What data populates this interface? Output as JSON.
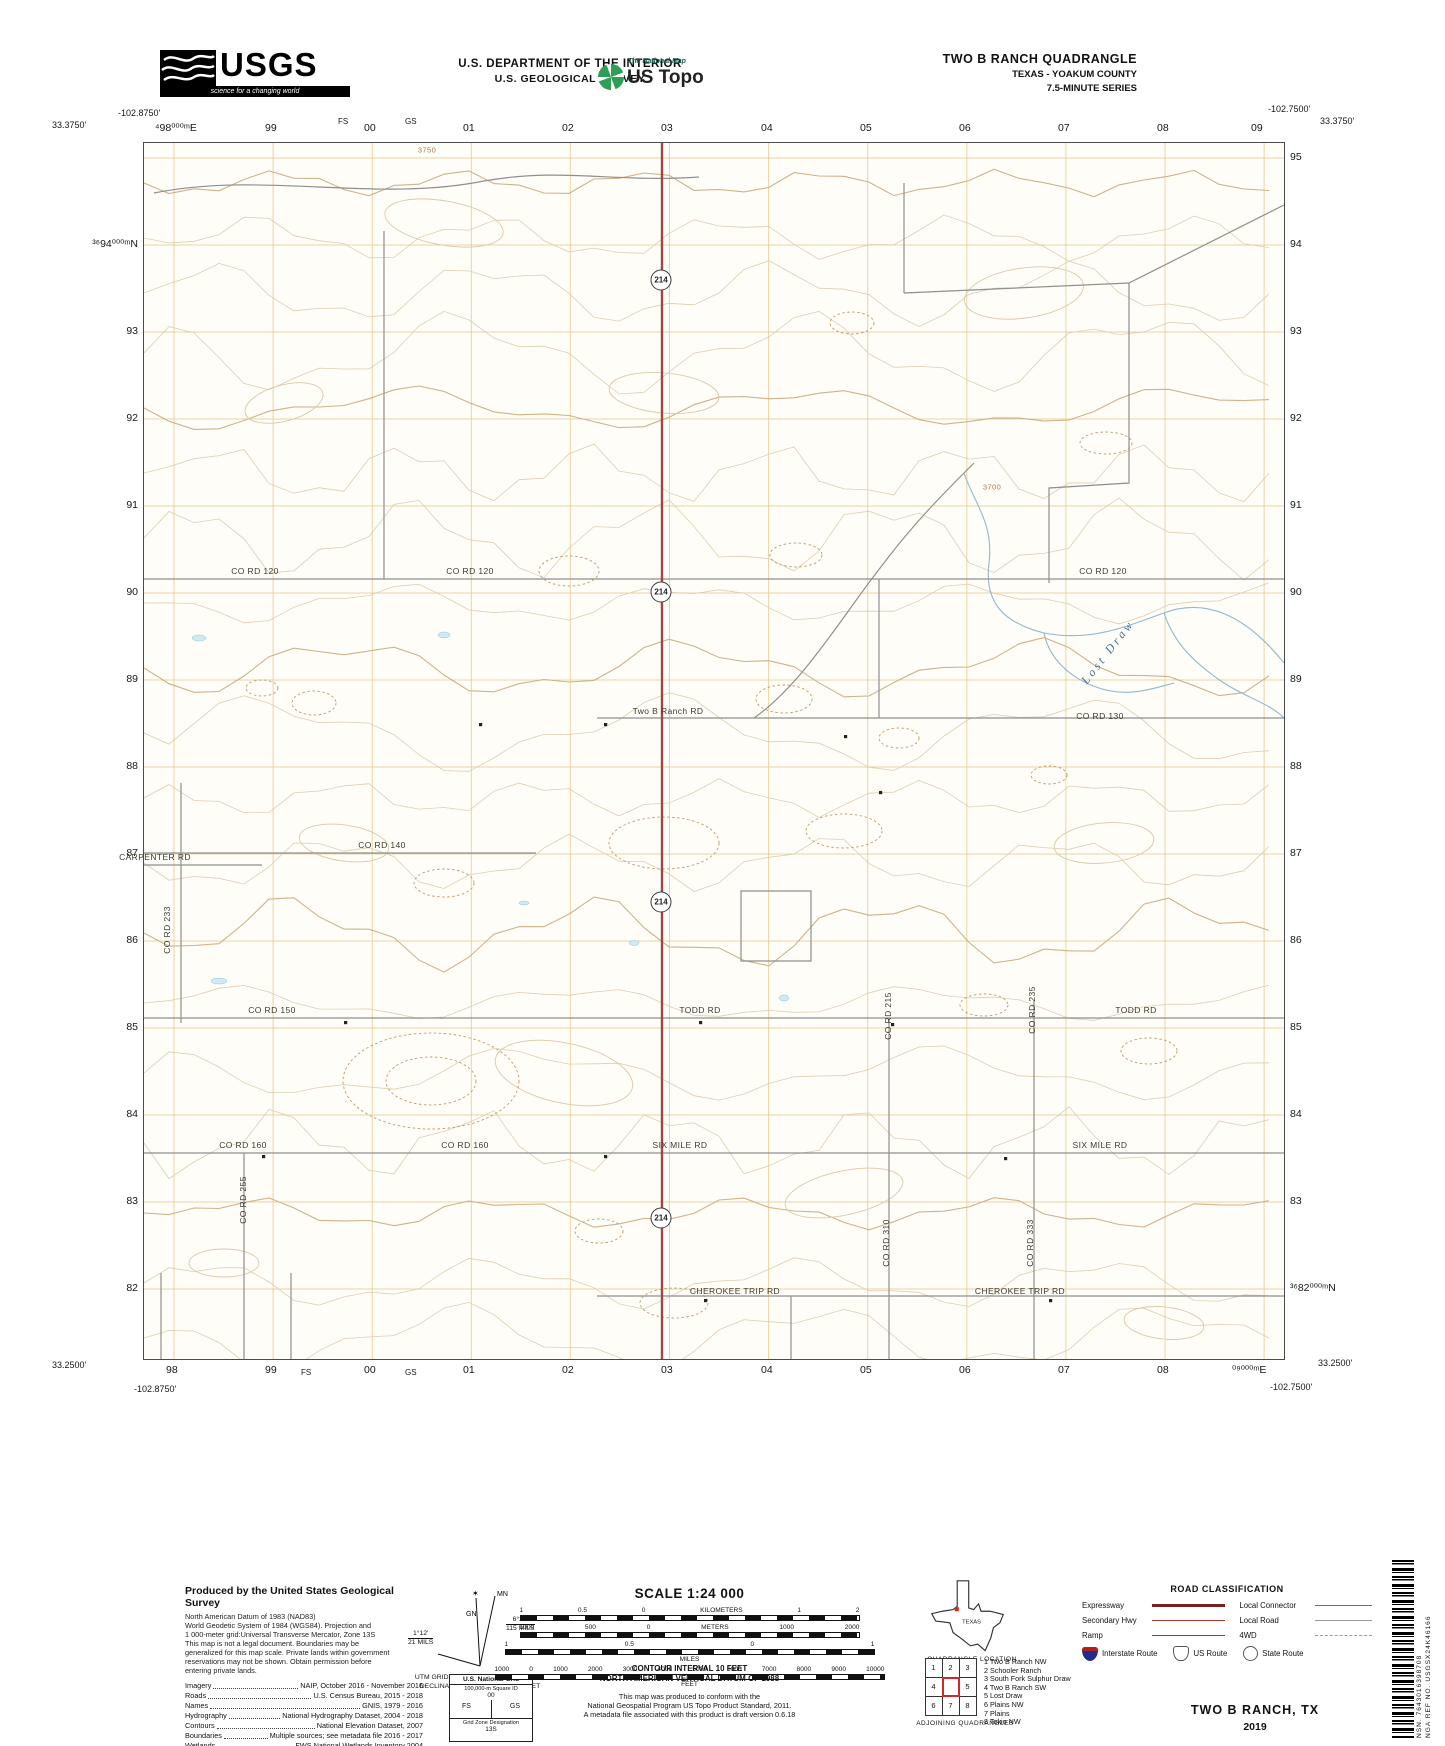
{
  "colors": {
    "accent_red": "#a04545",
    "grid_orange": "#e3c887",
    "contour_tan": "#dcc9a8",
    "index_contour": "#c9ab7e",
    "road_gray": "#8f8f8f",
    "stream_blue": "#90b8cc",
    "topo_green": "#2f9e57",
    "legend_dark_red": "#7a1d1d",
    "legend_red": "#a33a30"
  },
  "header": {
    "usgs": {
      "word": "USGS",
      "tagline": "science for a changing world"
    },
    "dept_line1": "U.S. DEPARTMENT OF THE INTERIOR",
    "dept_line2": "U.S. GEOLOGICAL SURVEY",
    "ustopo": {
      "small": "The National Map",
      "big": "US Topo"
    },
    "quad": {
      "line1": "TWO B RANCH QUADRANGLE",
      "line2": "TEXAS - YOAKUM COUNTY",
      "line3": "7.5-MINUTE SERIES"
    }
  },
  "corners": {
    "tl_lon": "-102.8750'",
    "tl_lat": "33.3750'",
    "tr_lon": "-102.7500'",
    "tr_lat": "33.3750'",
    "bl_lat": "33.2500'",
    "bl_lon": "-102.8750'",
    "br_lon": "-102.7500'",
    "br_lat": "33.2500'"
  },
  "grid": {
    "top": [
      {
        "x": 173,
        "label": "⁴98⁰⁰⁰ᵐE"
      },
      {
        "x": 272,
        "label": "99"
      },
      {
        "x": 345,
        "label": "FS",
        "small": true
      },
      {
        "x": 371,
        "label": "00"
      },
      {
        "x": 412,
        "label": "GS",
        "small": true
      },
      {
        "x": 470,
        "label": "01"
      },
      {
        "x": 569,
        "label": "02"
      },
      {
        "x": 668,
        "label": "03"
      },
      {
        "x": 768,
        "label": "04"
      },
      {
        "x": 867,
        "label": "05"
      },
      {
        "x": 966,
        "label": "06"
      },
      {
        "x": 1065,
        "label": "07"
      },
      {
        "x": 1164,
        "label": "08"
      },
      {
        "x": 1258,
        "label": "09"
      }
    ],
    "bottom": [
      {
        "x": 173,
        "label": "98"
      },
      {
        "x": 272,
        "label": "99"
      },
      {
        "x": 308,
        "label": "FS",
        "small": true
      },
      {
        "x": 371,
        "label": "00"
      },
      {
        "x": 412,
        "label": "GS",
        "small": true
      },
      {
        "x": 470,
        "label": "01"
      },
      {
        "x": 569,
        "label": "02"
      },
      {
        "x": 668,
        "label": "03"
      },
      {
        "x": 768,
        "label": "04"
      },
      {
        "x": 867,
        "label": "05"
      },
      {
        "x": 966,
        "label": "06"
      },
      {
        "x": 1065,
        "label": "07"
      },
      {
        "x": 1164,
        "label": "08"
      },
      {
        "x": 1250,
        "label": "⁰⁹⁰⁰⁰ᵐE"
      }
    ],
    "left": [
      {
        "y": 244,
        "label": "³⁶94⁰⁰⁰ᵐN"
      },
      {
        "y": 331,
        "label": "93"
      },
      {
        "y": 418,
        "label": "92"
      },
      {
        "y": 505,
        "label": "91"
      },
      {
        "y": 592,
        "label": "90"
      },
      {
        "y": 679,
        "label": "89"
      },
      {
        "y": 766,
        "label": "88"
      },
      {
        "y": 853,
        "label": "87"
      },
      {
        "y": 940,
        "label": "86"
      },
      {
        "y": 1027,
        "label": "85"
      },
      {
        "y": 1114,
        "label": "84"
      },
      {
        "y": 1201,
        "label": "83"
      },
      {
        "y": 1288,
        "label": "82"
      }
    ],
    "right": [
      {
        "y": 157,
        "label": "95"
      },
      {
        "y": 244,
        "label": "94"
      },
      {
        "y": 331,
        "label": "93"
      },
      {
        "y": 418,
        "label": "92"
      },
      {
        "y": 505,
        "label": "91"
      },
      {
        "y": 592,
        "label": "90"
      },
      {
        "y": 679,
        "label": "89"
      },
      {
        "y": 766,
        "label": "88"
      },
      {
        "y": 853,
        "label": "87"
      },
      {
        "y": 940,
        "label": "86"
      },
      {
        "y": 1027,
        "label": "85"
      },
      {
        "y": 1114,
        "label": "84"
      },
      {
        "y": 1201,
        "label": "83"
      },
      {
        "y": 1288,
        "label": "³⁶82⁰⁰⁰ᵐN"
      }
    ]
  },
  "map": {
    "shield_route": "214",
    "shields": [
      {
        "x": 661,
        "y": 280
      },
      {
        "x": 661,
        "y": 592
      },
      {
        "x": 661,
        "y": 902
      },
      {
        "x": 661,
        "y": 1218
      }
    ],
    "labels": [
      {
        "t": "CO RD 120",
        "x": 255,
        "y": 571
      },
      {
        "t": "CO RD 120",
        "x": 470,
        "y": 571
      },
      {
        "t": "CO RD 120",
        "x": 1103,
        "y": 571
      },
      {
        "t": "Two B Ranch  RD",
        "x": 668,
        "y": 711
      },
      {
        "t": "CO RD 130",
        "x": 1100,
        "y": 716
      },
      {
        "t": "CO RD 140",
        "x": 382,
        "y": 845
      },
      {
        "t": "CARPENTER RD",
        "x": 155,
        "y": 857
      },
      {
        "t": "CO RD 233",
        "x": 167,
        "y": 930,
        "rot": -90
      },
      {
        "t": "CO RD 150",
        "x": 272,
        "y": 1010
      },
      {
        "t": "TODD RD",
        "x": 700,
        "y": 1010
      },
      {
        "t": "TODD RD",
        "x": 1136,
        "y": 1010
      },
      {
        "t": "CO RD 215",
        "x": 888,
        "y": 1016,
        "rot": -90
      },
      {
        "t": "CO RD 235",
        "x": 1032,
        "y": 1010,
        "rot": -90
      },
      {
        "t": "CO RD 160",
        "x": 243,
        "y": 1145
      },
      {
        "t": "CO RD 160",
        "x": 465,
        "y": 1145
      },
      {
        "t": "SIX MILE RD",
        "x": 680,
        "y": 1145
      },
      {
        "t": "SIX MILE RD",
        "x": 1100,
        "y": 1145
      },
      {
        "t": "CO RD 255",
        "x": 243,
        "y": 1200,
        "rot": -90
      },
      {
        "t": "CO RD 310",
        "x": 886,
        "y": 1243,
        "rot": -90
      },
      {
        "t": "CO RD 333",
        "x": 1030,
        "y": 1243,
        "rot": -90
      },
      {
        "t": "CHEROKEE TRIP RD",
        "x": 735,
        "y": 1291
      },
      {
        "t": "CHEROKEE TRIP RD",
        "x": 1020,
        "y": 1291
      },
      {
        "t": "Lost Draw",
        "x": 1108,
        "y": 652,
        "rot": -52,
        "cls": "stream"
      },
      {
        "t": "3750",
        "x": 427,
        "y": 150,
        "cls": "contour"
      },
      {
        "t": "3700",
        "x": 992,
        "y": 487,
        "cls": "contour"
      }
    ]
  },
  "credits": {
    "title": "Produced by the United States Geological Survey",
    "lines": [
      "North American Datum of 1983 (NAD83)",
      "World Geodetic System of 1984 (WGS84).  Projection and",
      "1 000-meter grid:Universal Transverse Mercator, Zone 13S",
      "This map is not a legal document. Boundaries may be",
      "generalized for this map scale. Private lands within government",
      "reservations may not be shown. Obtain permission before",
      "entering private lands."
    ],
    "sources": [
      {
        "k": "Imagery",
        "v": "NAIP, October 2016 - November 2016"
      },
      {
        "k": "Roads",
        "v": "U.S. Census Bureau, 2015 - 2018"
      },
      {
        "k": "Names",
        "v": "GNIS, 1979 - 2016"
      },
      {
        "k": "Hydrography",
        "v": "National Hydrography Dataset, 2004 - 2018"
      },
      {
        "k": "Contours",
        "v": "National Elevation Dataset, 2007"
      },
      {
        "k": "Boundaries",
        "v": "Multiple sources; see metadata file 2016 - 2017"
      },
      {
        "k": "Wetlands",
        "v": "FWS National Wetlands Inventory 2004"
      }
    ]
  },
  "declination": {
    "mn_label": "MN",
    "gn_label": "GN",
    "star": "✶",
    "gn_deg": "1°12'",
    "gn_mils": "21 MILS",
    "mn_deg": "6°28'",
    "mn_mils": "115 MILS",
    "caption1": "UTM GRID AND 2019 MAGNETIC NORTH",
    "caption2": "DECLINATION AT CENTER OF SHEET"
  },
  "scale": {
    "title": "SCALE 1:24 000",
    "scalebars": [
      {
        "labels": [
          "1",
          "0.5",
          "0",
          "KILOMETERS",
          "1",
          "2"
        ],
        "unit": null
      },
      {
        "labels": [
          "1000",
          "500",
          "0",
          "METERS",
          "1000",
          "2000"
        ],
        "unit": null
      },
      {
        "labels": [
          "1",
          "0.5",
          "0",
          "1"
        ],
        "unit": "MILES"
      },
      {
        "labels": [
          "1000",
          "0",
          "1000",
          "2000",
          "3000",
          "4000",
          "5000",
          "6000",
          "7000",
          "8000",
          "9000",
          "10000"
        ],
        "unit": "FEET"
      }
    ],
    "contour_note": [
      "CONTOUR INTERVAL 10 FEET",
      "NORTH AMERICAN VERTICAL DATUM OF 1988"
    ],
    "standard_note": [
      "This map was produced to conform with the",
      "National Geospatial Program US Topo Product Standard, 2011.",
      "A metadata file associated with this product is draft version 0.6.18"
    ]
  },
  "usng": {
    "title": "U.S. National Grid",
    "sub": "100,000-m Square ID",
    "center": "00",
    "left": "FS",
    "right": "GS",
    "zone_label": "Grid Zone Designation",
    "zone": "13S"
  },
  "location": {
    "state": "TEXAS",
    "caption": "QUADRANGLE LOCATION"
  },
  "adjoining": {
    "caption": "ADJOINING QUADRANGLES",
    "cells": [
      "1",
      "2",
      "3",
      "4",
      "",
      "5",
      "6",
      "7",
      "8"
    ],
    "list": [
      "1 Two B Ranch NW",
      "2 Schooler Ranch",
      "3 South Fork Sulphur Draw",
      "4 Two B Ranch SW",
      "5 Lost Draw",
      "6 Plains NW",
      "7 Plains",
      "8 Tokio NW"
    ]
  },
  "road_class": {
    "title": "ROAD CLASSIFICATION",
    "rows": [
      {
        "l": "Expressway",
        "ls": "expressway",
        "r": "Local Connector",
        "rs": "connector"
      },
      {
        "l": "Secondary Hwy",
        "ls": "secondary",
        "r": "Local Road",
        "rs": "local"
      },
      {
        "l": "Ramp",
        "ls": "ramp",
        "r": "4WD",
        "rs": "fourwd"
      }
    ],
    "shields": [
      {
        "label": "Interstate Route",
        "type": "interstate"
      },
      {
        "label": "US Route",
        "type": "us"
      },
      {
        "label": "State Route",
        "type": "state"
      }
    ]
  },
  "footer_title": {
    "name": "TWO B RANCH,  TX",
    "year": "2019"
  },
  "barcode": {
    "nsn": "NSN. 7643016398708",
    "nga": "NGA REF NO. USGSX24K46166"
  }
}
